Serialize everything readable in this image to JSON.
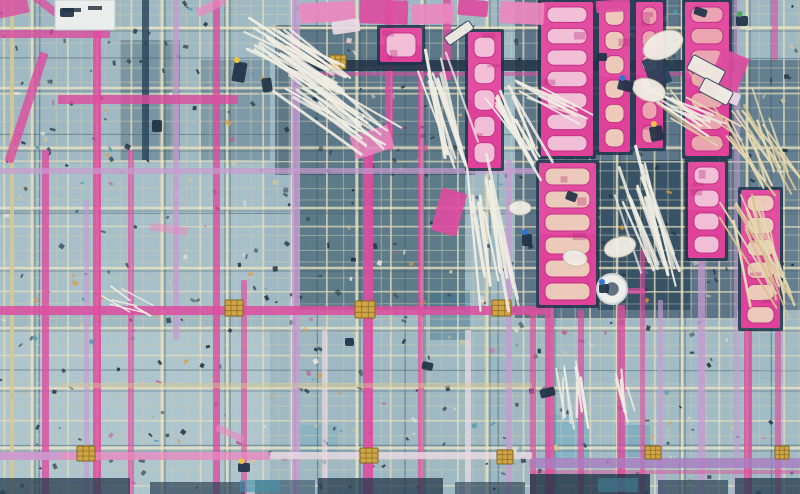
{
  "meta": {
    "w": 800,
    "h": 494,
    "alt": "Aerial photograph of a construction slab: dense blue-grey rebar mesh crossed by pink and lavender formwork beams, bright magenta formwork panels with pale slots in the upper right, bundles of white pipes, tan scaffold poles, yellow tie blocks and scattered tools"
  },
  "palette": {
    "P": "#e0459e",
    "p": "#ef83c0",
    "L": "#c79ad2",
    "W": "#eedce6",
    "C": "#d9c98e",
    "D": "#16293e",
    "N": "#1d3850",
    "U": "#a879c2",
    "M": "#e23a98",
    "w": "#f4f1e6",
    "t": "#e8dbb2"
  },
  "scene": {
    "background": {
      "base": "#9db9c4",
      "patches": [
        [
          0,
          330,
          270,
          164,
          "#bdd3d9",
          0.5
        ],
        [
          0,
          164,
          265,
          145,
          "#b0cad3",
          0.45
        ],
        [
          540,
          330,
          260,
          140,
          "#a6c3cf",
          0.35
        ],
        [
          275,
          25,
          200,
          150,
          "#26465e",
          0.6
        ],
        [
          295,
          170,
          170,
          140,
          "#1d4254",
          0.55
        ],
        [
          120,
          40,
          60,
          120,
          "#2c4c62",
          0.35
        ],
        [
          200,
          60,
          70,
          100,
          "#2c4c62",
          0.3
        ],
        [
          515,
          0,
          222,
          318,
          "#1b3550",
          0.55
        ],
        [
          598,
          160,
          92,
          150,
          "#16344a",
          0.6
        ],
        [
          737,
          60,
          63,
          250,
          "#204058",
          0.5
        ],
        [
          430,
          290,
          40,
          50,
          "#35708a",
          0.45
        ],
        [
          545,
          415,
          45,
          45,
          "#58a4c0",
          0.4
        ],
        [
          615,
          425,
          35,
          32,
          "#4f97b4",
          0.4
        ],
        [
          300,
          425,
          38,
          32,
          "#67aac0",
          0.35
        ]
      ]
    },
    "mesh": {
      "sx": 13,
      "sy": 13,
      "cx": 65,
      "cy": 60,
      "seed": 3
    },
    "debris": {
      "count": 520,
      "seed": 11
    },
    "vbeams": [
      [
        10,
        0,
        4,
        494,
        "C",
        0.85
      ],
      [
        42,
        150,
        7,
        344,
        "P",
        0.8
      ],
      [
        84,
        200,
        5,
        294,
        "L",
        0.6
      ],
      [
        93,
        0,
        8,
        494,
        "P",
        0.85
      ],
      [
        128,
        150,
        6,
        344,
        "P",
        0.65
      ],
      [
        142,
        0,
        7,
        160,
        "N",
        0.8
      ],
      [
        173,
        0,
        6,
        340,
        "L",
        0.75
      ],
      [
        213,
        0,
        7,
        494,
        "P",
        0.8
      ],
      [
        241,
        280,
        6,
        214,
        "P",
        0.65
      ],
      [
        292,
        0,
        8,
        494,
        "L",
        0.8
      ],
      [
        322,
        330,
        5,
        164,
        "W",
        0.65
      ],
      [
        363,
        150,
        10,
        344,
        "P",
        0.9
      ],
      [
        385,
        0,
        8,
        150,
        "P",
        0.8
      ],
      [
        418,
        60,
        6,
        434,
        "P",
        0.7
      ],
      [
        443,
        0,
        8,
        80,
        "P",
        0.8
      ],
      [
        465,
        330,
        6,
        164,
        "W",
        0.75
      ],
      [
        506,
        160,
        6,
        334,
        "L",
        0.75
      ],
      [
        530,
        310,
        6,
        184,
        "P",
        0.65
      ],
      [
        545,
        300,
        9,
        194,
        "P",
        0.85
      ],
      [
        578,
        310,
        6,
        184,
        "P",
        0.7
      ],
      [
        617,
        305,
        8,
        189,
        "P",
        0.8
      ],
      [
        640,
        250,
        5,
        244,
        "P",
        0.6
      ],
      [
        658,
        300,
        5,
        194,
        "L",
        0.65
      ],
      [
        698,
        258,
        7,
        236,
        "L",
        0.75
      ],
      [
        734,
        0,
        6,
        494,
        "L",
        0.55
      ],
      [
        744,
        330,
        8,
        164,
        "P",
        0.8
      ],
      [
        775,
        330,
        6,
        164,
        "P",
        0.65
      ],
      [
        772,
        0,
        6,
        60,
        "P",
        0.6
      ]
    ],
    "hbeams": [
      [
        0,
        30,
        110,
        8,
        "P",
        0.8
      ],
      [
        288,
        60,
        447,
        11,
        "D",
        0.85
      ],
      [
        288,
        72,
        447,
        4,
        "P",
        0.55
      ],
      [
        58,
        95,
        180,
        9,
        "P",
        0.8
      ],
      [
        0,
        168,
        535,
        6,
        "L",
        0.7
      ],
      [
        0,
        306,
        545,
        9,
        "P",
        0.85
      ],
      [
        60,
        383,
        472,
        5,
        "C",
        0.45
      ],
      [
        0,
        452,
        270,
        8,
        "p",
        0.75
      ],
      [
        0,
        452,
        62,
        8,
        "L",
        0.8
      ],
      [
        270,
        452,
        262,
        7,
        "W",
        0.8
      ],
      [
        532,
        458,
        268,
        10,
        "U",
        0.8
      ],
      [
        532,
        470,
        268,
        4,
        "P",
        0.45
      ],
      [
        590,
        288,
        55,
        6,
        "P",
        0.7
      ]
    ],
    "dbeams": [
      [
        22,
        50,
        9,
        115,
        18,
        "P",
        0.8
      ],
      [
        28,
        6,
        48,
        8,
        38,
        "P",
        0.75
      ],
      [
        -6,
        -4,
        34,
        20,
        -12,
        "P",
        0.8
      ],
      [
        196,
        2,
        30,
        9,
        -28,
        "p",
        0.7
      ],
      [
        352,
        130,
        40,
        24,
        -18,
        "p",
        0.85
      ],
      [
        150,
        225,
        38,
        8,
        8,
        "p",
        0.5
      ],
      [
        215,
        430,
        30,
        7,
        25,
        "p",
        0.6
      ]
    ],
    "connectors": [
      [
        225,
        300,
        18,
        16
      ],
      [
        355,
        301,
        20,
        17
      ],
      [
        492,
        300,
        19,
        16
      ],
      [
        77,
        446,
        18,
        15
      ],
      [
        360,
        448,
        18,
        15
      ],
      [
        497,
        450,
        16,
        14
      ],
      [
        645,
        446,
        16,
        13
      ],
      [
        775,
        446,
        14,
        13
      ],
      [
        330,
        55,
        16,
        14
      ],
      [
        695,
        60,
        16,
        14
      ]
    ],
    "slot_colors": {
      "c": "#f0d2bc",
      "s": "#efa9b2",
      "k": "#f6c6dc"
    },
    "panels": [
      [
        541,
        2,
        52,
        154,
        7,
        "k"
      ],
      [
        599,
        2,
        31,
        150,
        6,
        "c"
      ],
      [
        636,
        2,
        27,
        146,
        6,
        "s"
      ],
      [
        685,
        2,
        44,
        154,
        7,
        "s"
      ],
      [
        468,
        32,
        33,
        136,
        5,
        "k"
      ],
      [
        380,
        28,
        42,
        34,
        1,
        "k"
      ],
      [
        539,
        163,
        57,
        142,
        6,
        "c"
      ],
      [
        688,
        162,
        37,
        96,
        4,
        "k"
      ],
      [
        741,
        190,
        39,
        138,
        6,
        "c"
      ]
    ],
    "sheets": [
      [
        300,
        2,
        55,
        20,
        -3,
        "p"
      ],
      [
        360,
        0,
        48,
        24,
        2,
        "P"
      ],
      [
        412,
        4,
        42,
        20,
        -2,
        "p"
      ],
      [
        458,
        0,
        30,
        16,
        5,
        "P"
      ],
      [
        500,
        2,
        44,
        22,
        3,
        "p"
      ],
      [
        332,
        20,
        28,
        13,
        -8,
        "W"
      ],
      [
        596,
        0,
        34,
        12,
        -4,
        "P"
      ],
      [
        712,
        52,
        30,
        48,
        22,
        "P"
      ],
      [
        716,
        90,
        24,
        12,
        22,
        "W"
      ],
      [
        646,
        56,
        22,
        30,
        -20,
        "N"
      ],
      [
        436,
        190,
        26,
        44,
        15,
        "P"
      ]
    ],
    "rods": [
      [
        303,
        60,
        92,
        32,
        16,
        22,
        42,
        "w",
        2.6
      ],
      [
        335,
        112,
        100,
        36,
        14,
        18,
        40,
        "w",
        2.6
      ],
      [
        448,
        110,
        88,
        74,
        12,
        13,
        34,
        "w",
        2.6
      ],
      [
        520,
        130,
        80,
        60,
        18,
        10,
        30,
        "w",
        2.4
      ],
      [
        487,
        235,
        120,
        80,
        10,
        12,
        34,
        "w",
        2.6
      ],
      [
        643,
        222,
        112,
        70,
        14,
        13,
        36,
        "w",
        2.6
      ],
      [
        762,
        150,
        85,
        62,
        26,
        16,
        40,
        "t",
        2.2
      ],
      [
        758,
        255,
        90,
        68,
        24,
        16,
        42,
        "t",
        2.2
      ],
      [
        700,
        120,
        70,
        40,
        30,
        8,
        40,
        "t",
        2.0
      ],
      [
        572,
        398,
        55,
        84,
        14,
        8,
        26,
        "w",
        2.2
      ],
      [
        628,
        395,
        40,
        80,
        16,
        5,
        18,
        "w",
        2.0
      ],
      [
        130,
        300,
        30,
        30,
        40,
        6,
        30,
        "w",
        1.8
      ],
      [
        560,
        105,
        60,
        25,
        20,
        7,
        30,
        "w",
        2.2
      ],
      [
        690,
        115,
        55,
        28,
        24,
        8,
        30,
        "w",
        2.2
      ]
    ],
    "white_objects": [
      [
        "e",
        663,
        45,
        21,
        13,
        -25
      ],
      [
        "e",
        649,
        90,
        17,
        11,
        20
      ],
      [
        "e",
        620,
        247,
        16,
        10,
        -15
      ],
      [
        "r",
        688,
        62,
        36,
        16,
        28
      ],
      [
        "r",
        700,
        84,
        32,
        15,
        28
      ],
      [
        "r",
        444,
        28,
        30,
        10,
        -35
      ],
      [
        "ring",
        612,
        289,
        15
      ],
      [
        "e",
        575,
        258,
        12,
        8,
        10
      ],
      [
        "e",
        520,
        208,
        11,
        7,
        0
      ]
    ],
    "board_panel": {
      "x": 55,
      "y": 0,
      "w": 60,
      "h": 30,
      "marks": [
        [
          63,
          8,
          18,
          4
        ],
        [
          88,
          6,
          14,
          4
        ]
      ]
    },
    "blobs": [
      [
        233,
        62,
        13,
        20,
        10,
        "#eec33c"
      ],
      [
        262,
        78,
        10,
        14,
        -8,
        null
      ],
      [
        618,
        80,
        15,
        11,
        15,
        "#2f6fd0"
      ],
      [
        650,
        126,
        13,
        15,
        -10,
        "#eec33c"
      ],
      [
        597,
        53,
        10,
        8,
        0,
        null
      ],
      [
        566,
        192,
        11,
        9,
        20,
        null
      ],
      [
        599,
        284,
        10,
        9,
        0,
        "#2f6fd0"
      ],
      [
        422,
        362,
        11,
        8,
        12,
        null
      ],
      [
        540,
        388,
        15,
        9,
        -14,
        null
      ],
      [
        736,
        16,
        12,
        10,
        0,
        "#3fae58"
      ],
      [
        694,
        8,
        13,
        8,
        18,
        null
      ],
      [
        60,
        8,
        14,
        9,
        0,
        null
      ],
      [
        152,
        120,
        10,
        12,
        0,
        null
      ],
      [
        345,
        338,
        9,
        8,
        0,
        null
      ],
      [
        238,
        463,
        12,
        9,
        0,
        "#eec33c"
      ],
      [
        522,
        234,
        10,
        12,
        0,
        "#2f6fd0"
      ]
    ],
    "bottom_band": [
      [
        0,
        478,
        130,
        16,
        "#1c3348",
        0.75
      ],
      [
        150,
        482,
        95,
        12,
        "#223a50",
        0.7
      ],
      [
        255,
        480,
        60,
        14,
        "#2a4a62",
        0.6
      ],
      [
        318,
        478,
        125,
        16,
        "#1a3046",
        0.75
      ],
      [
        455,
        482,
        70,
        12,
        "#223a50",
        0.65
      ],
      [
        530,
        474,
        120,
        20,
        "#16293e",
        0.8
      ],
      [
        658,
        480,
        70,
        14,
        "#223a50",
        0.7
      ],
      [
        735,
        478,
        65,
        16,
        "#1c3348",
        0.75
      ],
      [
        240,
        480,
        40,
        12,
        "#3e8fa8",
        0.6
      ],
      [
        598,
        478,
        40,
        14,
        "#3a86a0",
        0.5
      ]
    ]
  }
}
